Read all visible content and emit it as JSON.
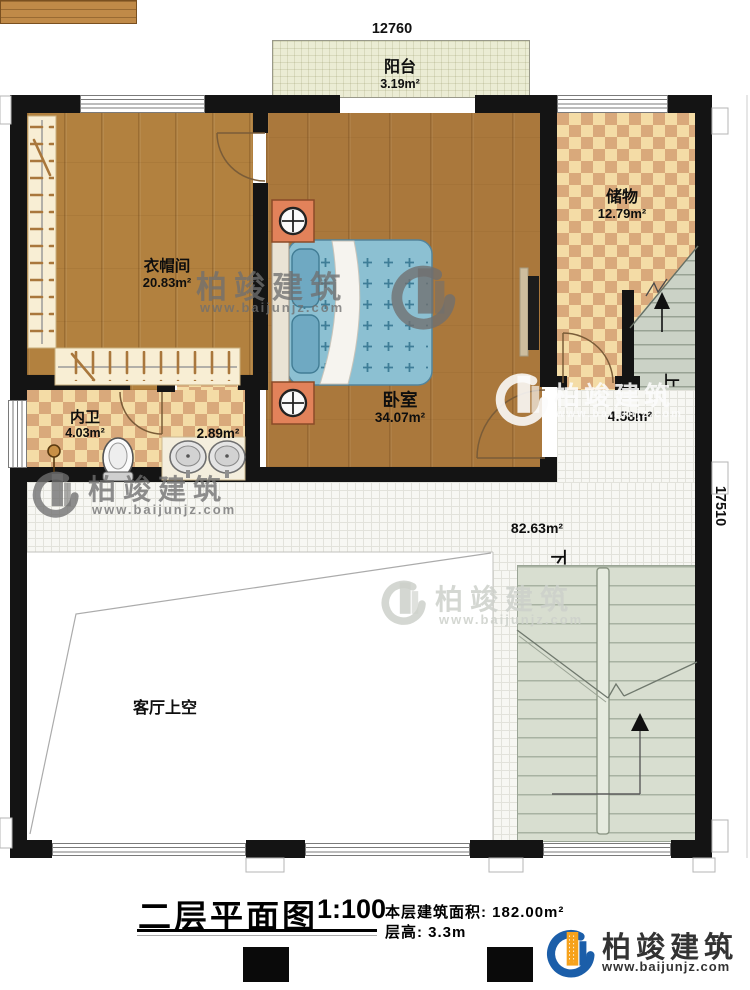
{
  "dimensions": {
    "width": "12760",
    "height": "17510"
  },
  "rooms": [
    {
      "id": "balcony",
      "name": "阳台",
      "area": "3.19m²"
    },
    {
      "id": "cloakroom",
      "name": "衣帽间",
      "area": "20.83m²"
    },
    {
      "id": "bedroom",
      "name": "卧室",
      "area": "34.07m²"
    },
    {
      "id": "storage",
      "name": "储物",
      "area": "12.79m²"
    },
    {
      "id": "bathroom",
      "name": "内卫",
      "area": "4.03m²"
    },
    {
      "id": "vanity",
      "name": "",
      "area": "2.89m²"
    },
    {
      "id": "hall",
      "name": "",
      "area": "4.58m²"
    },
    {
      "id": "landing",
      "name": "",
      "area": "82.63m²"
    },
    {
      "id": "living-void",
      "name": "客厅上空",
      "area": ""
    }
  ],
  "stairs": {
    "up": "上",
    "down": "下"
  },
  "footer": {
    "title": "二层平面图",
    "scale": "1:100",
    "area_label": "本层建筑面积:",
    "area_value": "182.00m²",
    "height_label": "层高:",
    "height_value": "3.3m"
  },
  "brand": {
    "name": "柏竣建筑",
    "url": "www.baijunjz.com"
  },
  "colors": {
    "brand_blue": "#1b5ea9",
    "brand_orange": "#f6a21c",
    "wall": "#141414"
  }
}
